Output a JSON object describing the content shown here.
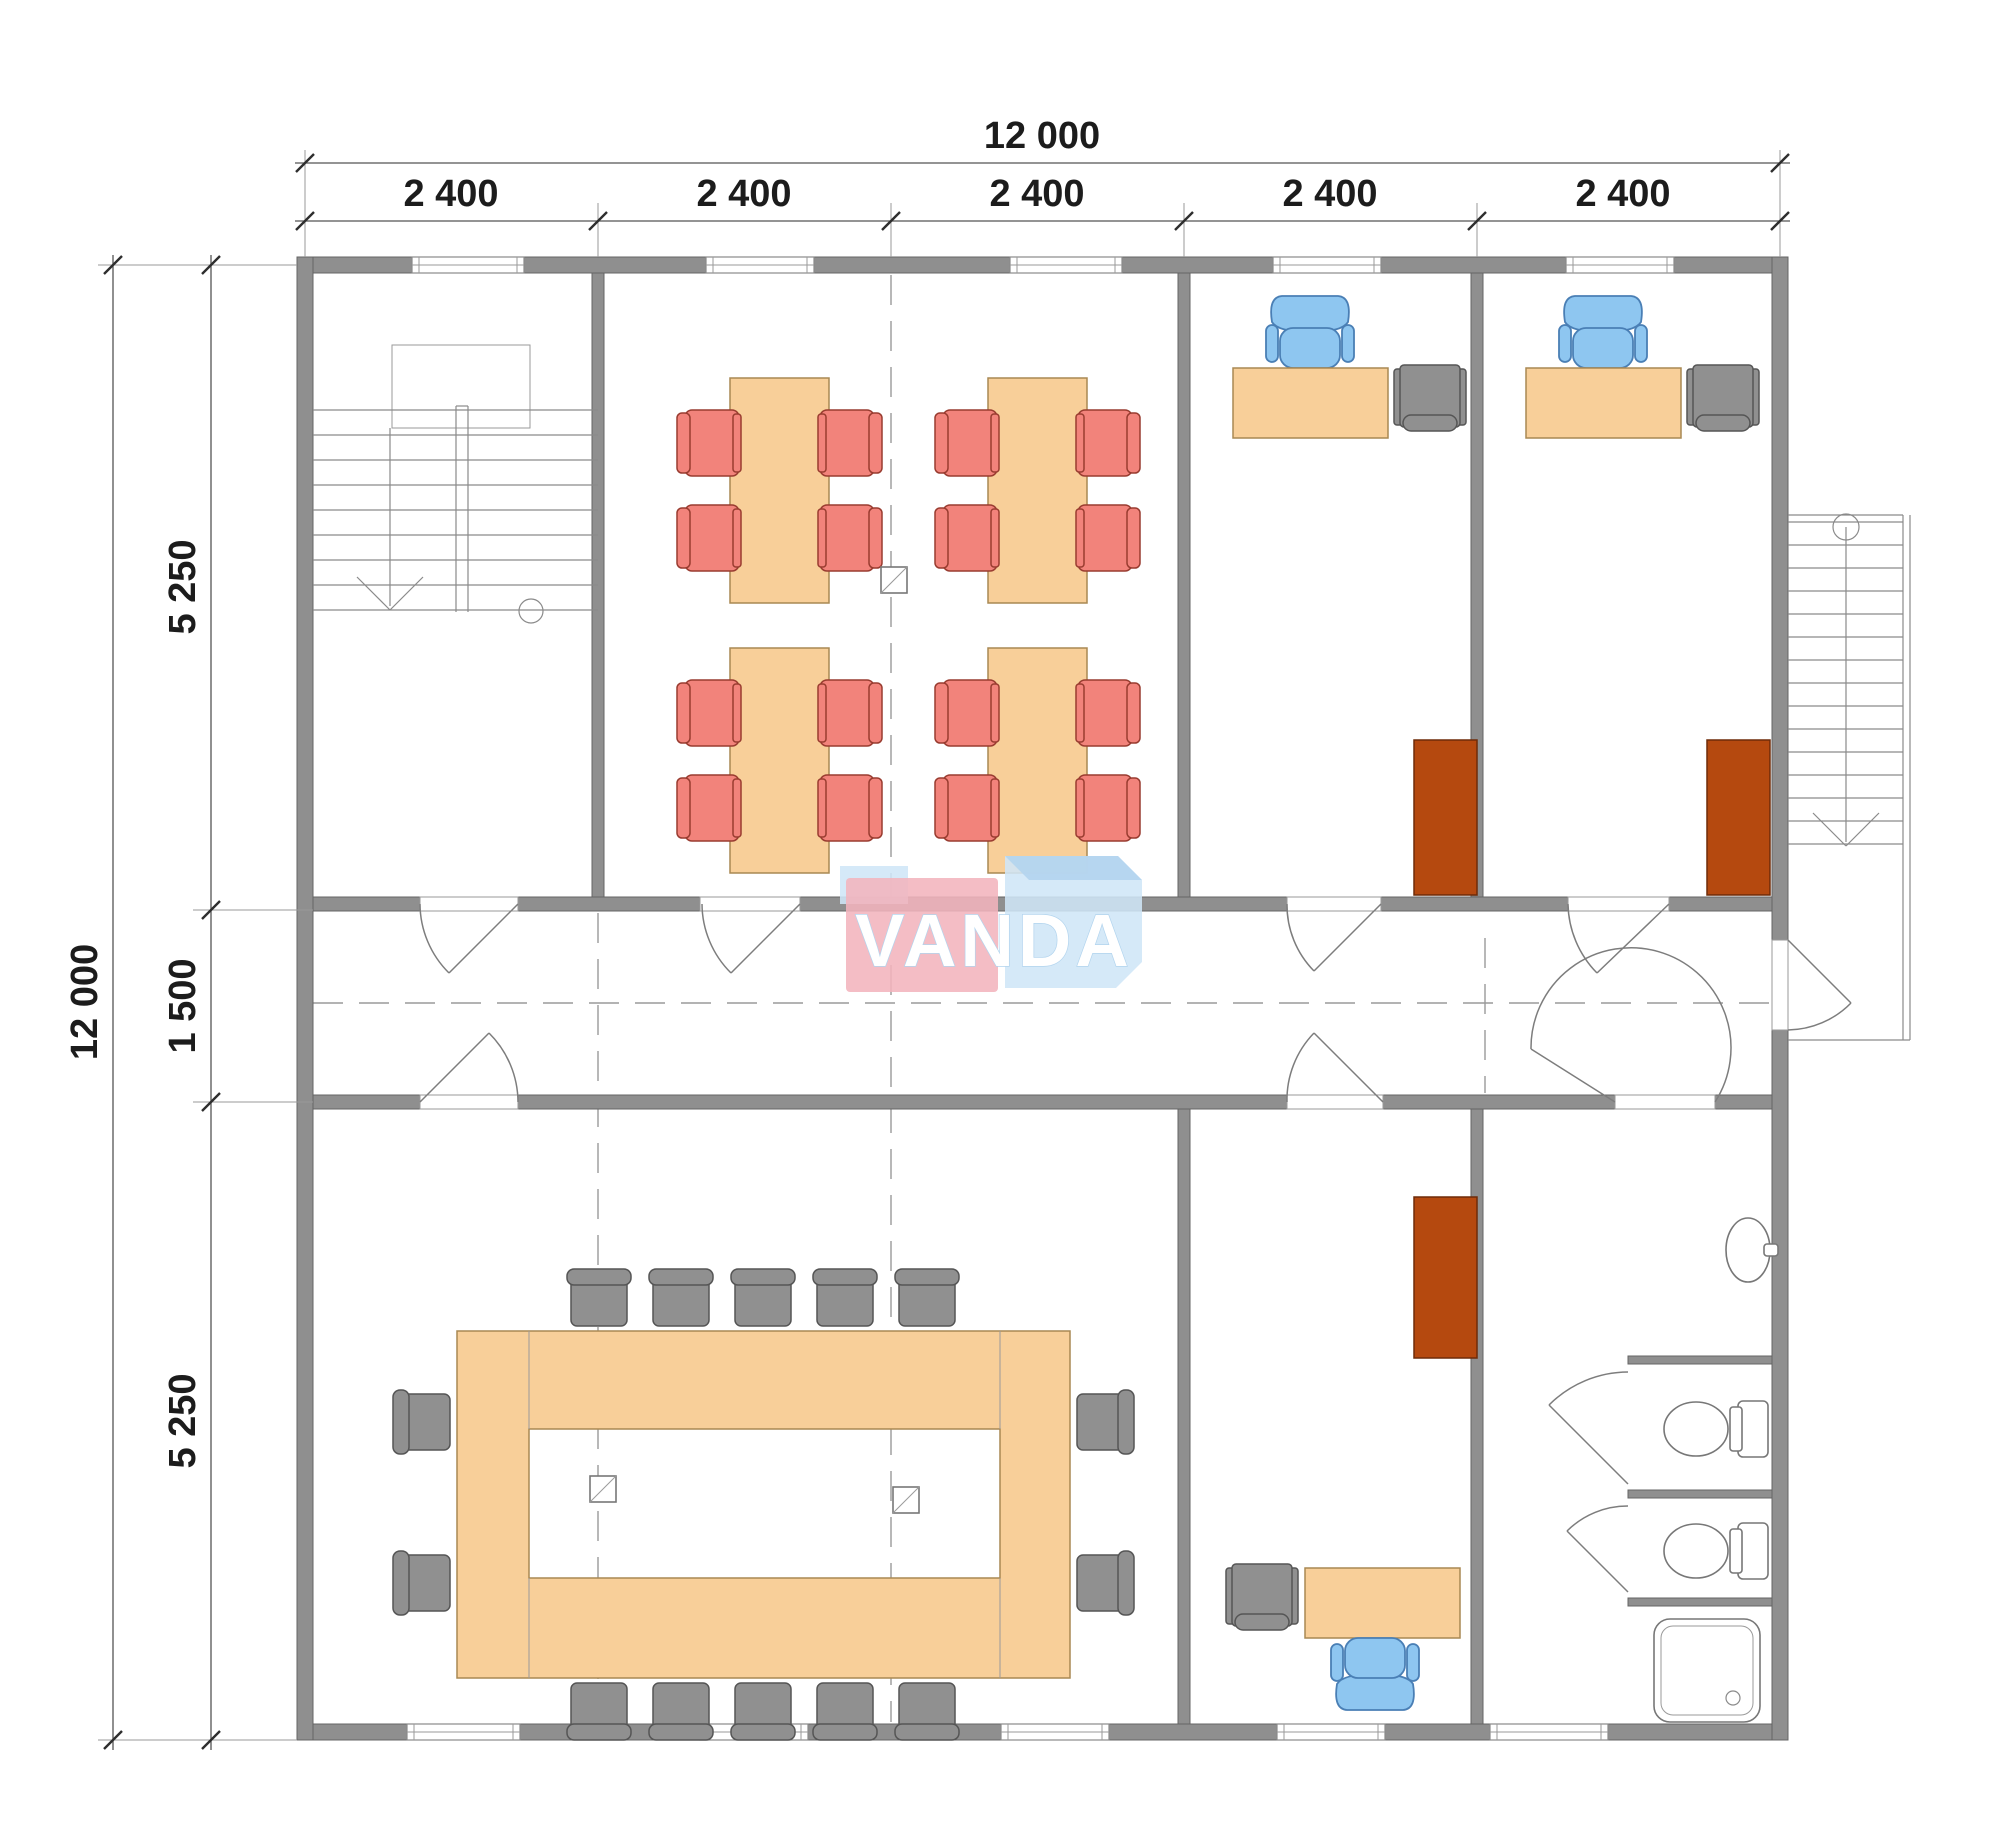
{
  "dimensions": {
    "top_total": "12 000",
    "top_segments": [
      "2 400",
      "2 400",
      "2 400",
      "2 400",
      "2 400"
    ],
    "left_total": "12 000",
    "left_top": "5 250",
    "left_mid": "1 500",
    "left_bottom": "5 250"
  },
  "logo": {
    "text": "VANDA"
  },
  "colors": {
    "wall": "#8f8f8f",
    "wall_stroke": "#646464",
    "desk": "#f8cf99",
    "desk_stroke": "#a98953",
    "chair_red": "#f2837b",
    "chair_red_stroke": "#993c30",
    "chair_blue": "#8ec6f0",
    "chair_blue_stroke": "#4a7fb5",
    "chair_gray": "#909090",
    "chair_gray_stroke": "#555555",
    "cabinet": "#b5490f",
    "cabinet_stroke": "#6e2b08",
    "logo_pink": "#f3b4bd",
    "logo_blue": "#cfe6f7",
    "logo_blue_dark": "#b2d4ee",
    "logo_text": "#ffffff"
  }
}
